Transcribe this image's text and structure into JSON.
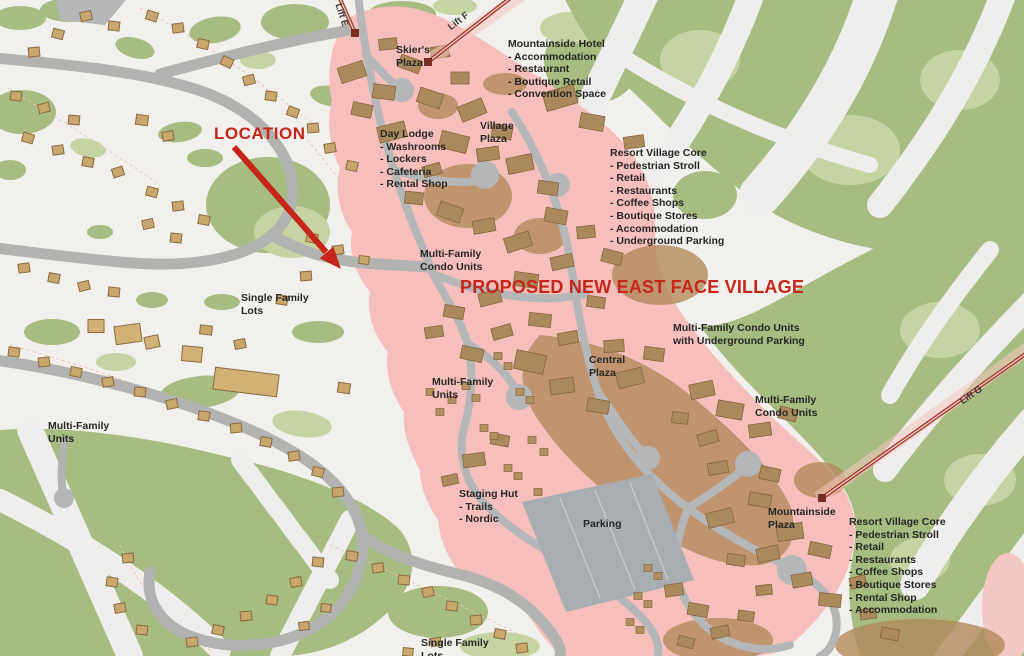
{
  "map": {
    "location_callout": "LOCATION",
    "banner": "PROPOSED NEW EAST FACE VILLAGE",
    "lifts": {
      "e": "Lift E",
      "f": "Lift F",
      "g": "Lift G"
    },
    "labels": {
      "skiers_plaza": "Skier's\nPlaza",
      "mountainside_hotel": "Mountainside Hotel\n- Accommodation\n- Restaurant\n- Boutique Retail\n- Convention Space",
      "day_lodge": "Day Lodge\n- Washrooms\n- Lockers\n- Cafeteria\n- Rental Shop",
      "village_plaza": "Village\nPlaza",
      "resort_village_core_north": "Resort Village Core\n- Pedestrian Stroll\n- Retail\n- Restaurants\n- Coffee Shops\n- Boutique Stores\n- Accommodation\n- Underground Parking",
      "multi_family_condo_units_west": "Multi-Family\nCondo Units",
      "single_family_lots_west": "Single Family\nLots",
      "condo_units_underground_parking": "Multi-Family Condo Units\nwith Underground Parking",
      "central_plaza": "Central\nPlaza",
      "multi_family_units_central": "Multi-Family\nUnits",
      "multi_family_condo_units_east": "Multi-Family\nCondo Units",
      "multi_family_units_west": "Multi-Family\nUnits",
      "staging_hut": "Staging Hut\n- Trails\n- Nordic",
      "parking": "Parking",
      "mountainside_plaza": "Mountainside\nPlaza",
      "resort_village_core_south": "Resort Village Core\n- Pedestrian Stroll\n- Retail\n- Restaurants\n- Coffee Shops\n- Boutique Stores\n- Rental Shop\n- Accommodation",
      "single_family_lots_south": "Single Family\nLots"
    },
    "colors": {
      "base": "#f2f0ec",
      "forest_green": "#a6bc80",
      "light_green": "#c6d4a3",
      "village_overlay": "#f6bfbc",
      "road_gray": "#b2b3b1",
      "parking_gray": "#a8adb1",
      "house_tan": "#c9a76c",
      "building_tan": "#aa8a5c",
      "lift_red": "#a83c32",
      "callout_red": "#c6261a",
      "text_dark": "#262624"
    }
  },
  "map_shapes": {
    "houses": [
      [
        152,
        16,
        11,
        9,
        18
      ],
      [
        178,
        28,
        11,
        9,
        -8
      ],
      [
        203,
        44,
        11,
        9,
        12
      ],
      [
        227,
        62,
        11,
        9,
        25
      ],
      [
        249,
        80,
        11,
        9,
        -15
      ],
      [
        271,
        96,
        11,
        9,
        8
      ],
      [
        293,
        112,
        11,
        9,
        20
      ],
      [
        313,
        128,
        11,
        9,
        -5
      ],
      [
        86,
        16,
        11,
        9,
        -12
      ],
      [
        114,
        26,
        11,
        9,
        6
      ],
      [
        58,
        34,
        11,
        9,
        15
      ],
      [
        34,
        52,
        11,
        9,
        -6
      ],
      [
        16,
        96,
        11,
        9,
        8
      ],
      [
        44,
        108,
        11,
        9,
        -14
      ],
      [
        74,
        120,
        11,
        9,
        5
      ],
      [
        28,
        138,
        11,
        9,
        16
      ],
      [
        58,
        150,
        11,
        9,
        -8
      ],
      [
        88,
        162,
        11,
        9,
        10
      ],
      [
        118,
        172,
        11,
        9,
        -18
      ],
      [
        142,
        120,
        12,
        10,
        8
      ],
      [
        168,
        136,
        11,
        9,
        -10
      ],
      [
        152,
        192,
        11,
        9,
        14
      ],
      [
        178,
        206,
        11,
        9,
        -6
      ],
      [
        204,
        220,
        11,
        9,
        10
      ],
      [
        148,
        224,
        11,
        9,
        -12
      ],
      [
        176,
        238,
        11,
        9,
        6
      ],
      [
        24,
        268,
        11,
        9,
        -8
      ],
      [
        54,
        278,
        11,
        9,
        10
      ],
      [
        84,
        286,
        11,
        9,
        -14
      ],
      [
        114,
        292,
        11,
        9,
        6
      ],
      [
        312,
        238,
        11,
        9,
        12
      ],
      [
        338,
        250,
        11,
        9,
        -8
      ],
      [
        364,
        260,
        10,
        8,
        6
      ],
      [
        330,
        148,
        11,
        9,
        -10
      ],
      [
        352,
        166,
        11,
        9,
        12
      ],
      [
        306,
        276,
        11,
        9,
        -5
      ],
      [
        282,
        300,
        11,
        9,
        10
      ],
      [
        206,
        330,
        12,
        9,
        6
      ],
      [
        240,
        344,
        11,
        9,
        -10
      ],
      [
        14,
        352,
        11,
        9,
        8
      ],
      [
        44,
        362,
        11,
        9,
        -6
      ],
      [
        76,
        372,
        11,
        9,
        12
      ],
      [
        108,
        382,
        11,
        9,
        -10
      ],
      [
        140,
        392,
        11,
        9,
        6
      ],
      [
        172,
        404,
        11,
        9,
        -12
      ],
      [
        204,
        416,
        11,
        9,
        8
      ],
      [
        236,
        428,
        11,
        9,
        -6
      ],
      [
        266,
        442,
        11,
        9,
        10
      ],
      [
        294,
        456,
        11,
        9,
        -8
      ],
      [
        318,
        472,
        11,
        9,
        14
      ],
      [
        338,
        492,
        11,
        9,
        -6
      ],
      [
        344,
        388,
        12,
        10,
        8
      ],
      [
        352,
        556,
        11,
        9,
        10
      ],
      [
        378,
        568,
        11,
        9,
        -8
      ],
      [
        404,
        580,
        11,
        9,
        6
      ],
      [
        428,
        592,
        11,
        9,
        -12
      ],
      [
        452,
        606,
        11,
        9,
        8
      ],
      [
        476,
        620,
        11,
        9,
        -6
      ],
      [
        500,
        634,
        11,
        9,
        10
      ],
      [
        522,
        648,
        11,
        9,
        -8
      ],
      [
        318,
        562,
        11,
        9,
        6
      ],
      [
        296,
        582,
        11,
        9,
        -10
      ],
      [
        272,
        600,
        11,
        9,
        8
      ],
      [
        246,
        616,
        11,
        9,
        -6
      ],
      [
        218,
        630,
        11,
        9,
        12
      ],
      [
        192,
        642,
        11,
        9,
        -8
      ],
      [
        326,
        608,
        10,
        8,
        6
      ],
      [
        304,
        626,
        10,
        8,
        -8
      ],
      [
        128,
        558,
        11,
        9,
        -6
      ],
      [
        112,
        582,
        11,
        9,
        8
      ],
      [
        120,
        608,
        11,
        9,
        -10
      ],
      [
        142,
        630,
        11,
        9,
        6
      ],
      [
        436,
        642,
        10,
        8,
        -8
      ],
      [
        408,
        652,
        10,
        8,
        6
      ]
    ],
    "large_buildings": [
      [
        246,
        382,
        64,
        22,
        7
      ],
      [
        128,
        334,
        26,
        18,
        -8
      ],
      [
        192,
        354,
        20,
        15,
        5
      ],
      [
        96,
        326,
        16,
        13,
        0
      ],
      [
        152,
        342,
        14,
        12,
        -12
      ]
    ],
    "village_buildings": [
      [
        352,
        72,
        26,
        16,
        -18
      ],
      [
        384,
        92,
        22,
        14,
        8
      ],
      [
        410,
        64,
        22,
        13,
        20
      ],
      [
        440,
        52,
        18,
        12,
        -10
      ],
      [
        388,
        44,
        18,
        11,
        -6
      ],
      [
        362,
        110,
        20,
        13,
        12
      ],
      [
        392,
        132,
        28,
        16,
        -14
      ],
      [
        430,
        98,
        24,
        15,
        18
      ],
      [
        460,
        78,
        18,
        12,
        0
      ],
      [
        472,
        110,
        26,
        16,
        -22
      ],
      [
        502,
        132,
        20,
        13,
        10
      ],
      [
        454,
        142,
        28,
        17,
        14
      ],
      [
        488,
        154,
        22,
        13,
        -8
      ],
      [
        560,
        98,
        32,
        19,
        -16
      ],
      [
        592,
        122,
        24,
        15,
        10
      ],
      [
        634,
        142,
        20,
        12,
        -8
      ],
      [
        520,
        164,
        26,
        16,
        -12
      ],
      [
        548,
        188,
        20,
        13,
        8
      ],
      [
        432,
        170,
        18,
        11,
        -16
      ],
      [
        414,
        198,
        18,
        12,
        6
      ],
      [
        450,
        212,
        24,
        15,
        20
      ],
      [
        484,
        226,
        22,
        13,
        -10
      ],
      [
        518,
        242,
        26,
        15,
        -18
      ],
      [
        556,
        216,
        22,
        14,
        10
      ],
      [
        586,
        232,
        18,
        12,
        -6
      ],
      [
        612,
        257,
        20,
        13,
        14
      ],
      [
        562,
        262,
        22,
        13,
        -12
      ],
      [
        526,
        280,
        24,
        14,
        8
      ],
      [
        490,
        298,
        22,
        13,
        -14
      ],
      [
        454,
        312,
        20,
        12,
        10
      ],
      [
        434,
        332,
        18,
        11,
        -8
      ],
      [
        472,
        354,
        22,
        13,
        12
      ],
      [
        502,
        332,
        20,
        12,
        -16
      ],
      [
        540,
        320,
        22,
        13,
        6
      ],
      [
        568,
        338,
        20,
        12,
        -10
      ],
      [
        530,
        362,
        30,
        19,
        12
      ],
      [
        562,
        386,
        24,
        15,
        -8
      ],
      [
        598,
        406,
        22,
        13,
        10
      ],
      [
        630,
        378,
        26,
        16,
        -14
      ],
      [
        654,
        354,
        20,
        13,
        8
      ],
      [
        614,
        346,
        20,
        12,
        -4
      ],
      [
        596,
        302,
        18,
        11,
        8
      ],
      [
        702,
        390,
        24,
        15,
        -12
      ],
      [
        730,
        410,
        26,
        16,
        10
      ],
      [
        760,
        430,
        22,
        13,
        -8
      ],
      [
        788,
        414,
        18,
        12,
        14
      ],
      [
        708,
        438,
        20,
        12,
        -16
      ],
      [
        680,
        418,
        16,
        11,
        6
      ],
      [
        718,
        468,
        20,
        12,
        -10
      ],
      [
        770,
        474,
        20,
        13,
        12
      ],
      [
        720,
        518,
        26,
        15,
        -14
      ],
      [
        760,
        500,
        22,
        13,
        10
      ],
      [
        790,
        532,
        26,
        16,
        -8
      ],
      [
        820,
        550,
        22,
        13,
        12
      ],
      [
        768,
        554,
        22,
        14,
        -12
      ],
      [
        736,
        560,
        18,
        11,
        8
      ],
      [
        802,
        580,
        20,
        13,
        -10
      ],
      [
        830,
        600,
        22,
        13,
        6
      ],
      [
        858,
        582,
        16,
        11,
        -14
      ],
      [
        474,
        460,
        22,
        13,
        -8
      ],
      [
        500,
        440,
        18,
        11,
        10
      ],
      [
        450,
        480,
        16,
        10,
        -12
      ],
      [
        674,
        590,
        18,
        12,
        -8
      ],
      [
        698,
        610,
        20,
        12,
        10
      ],
      [
        720,
        632,
        18,
        11,
        -12
      ],
      [
        746,
        616,
        16,
        10,
        8
      ],
      [
        764,
        590,
        16,
        10,
        -6
      ],
      [
        686,
        642,
        16,
        10,
        14
      ],
      [
        868,
        614,
        16,
        10,
        -8
      ],
      [
        890,
        634,
        18,
        11,
        10
      ]
    ],
    "tiny_buildings": [
      [
        498,
        356
      ],
      [
        508,
        366
      ],
      [
        520,
        392
      ],
      [
        530,
        400
      ],
      [
        484,
        428
      ],
      [
        494,
        436
      ],
      [
        508,
        468
      ],
      [
        518,
        476
      ],
      [
        538,
        492
      ],
      [
        476,
        398
      ],
      [
        466,
        386
      ],
      [
        452,
        400
      ],
      [
        440,
        412
      ],
      [
        430,
        392
      ],
      [
        532,
        440
      ],
      [
        544,
        452
      ],
      [
        648,
        568
      ],
      [
        658,
        576
      ],
      [
        638,
        596
      ],
      [
        648,
        604
      ],
      [
        630,
        622
      ],
      [
        640,
        630
      ]
    ]
  }
}
